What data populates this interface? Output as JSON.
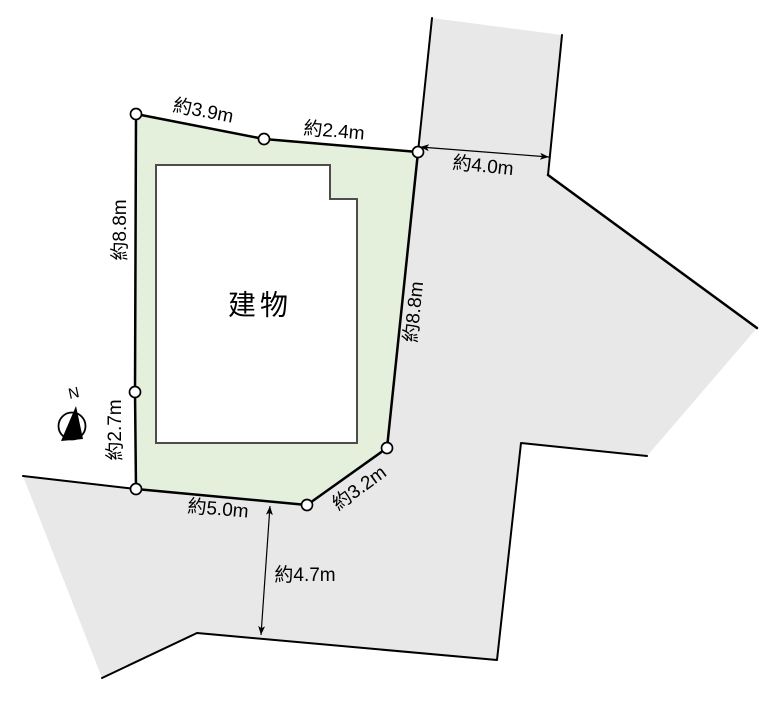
{
  "diagram": {
    "building_label": "建物",
    "compass_label": "N",
    "dimensions": {
      "top_left": "約3.9m",
      "top_right": "約2.4m",
      "road_top_width": "約4.0m",
      "left_upper": "約8.8m",
      "left_lower": "約2.7m",
      "right_side": "約8.8m",
      "bottom_right_diagonal": "約3.2m",
      "bottom": "約5.0m",
      "road_bottom_width": "約4.7m"
    },
    "colors": {
      "lot_fill": "#e4f0db",
      "road_fill": "#e8e8e8",
      "building_fill": "#ffffff",
      "boundary_line": "#000000",
      "building_outline": "#4d4d4d"
    }
  }
}
